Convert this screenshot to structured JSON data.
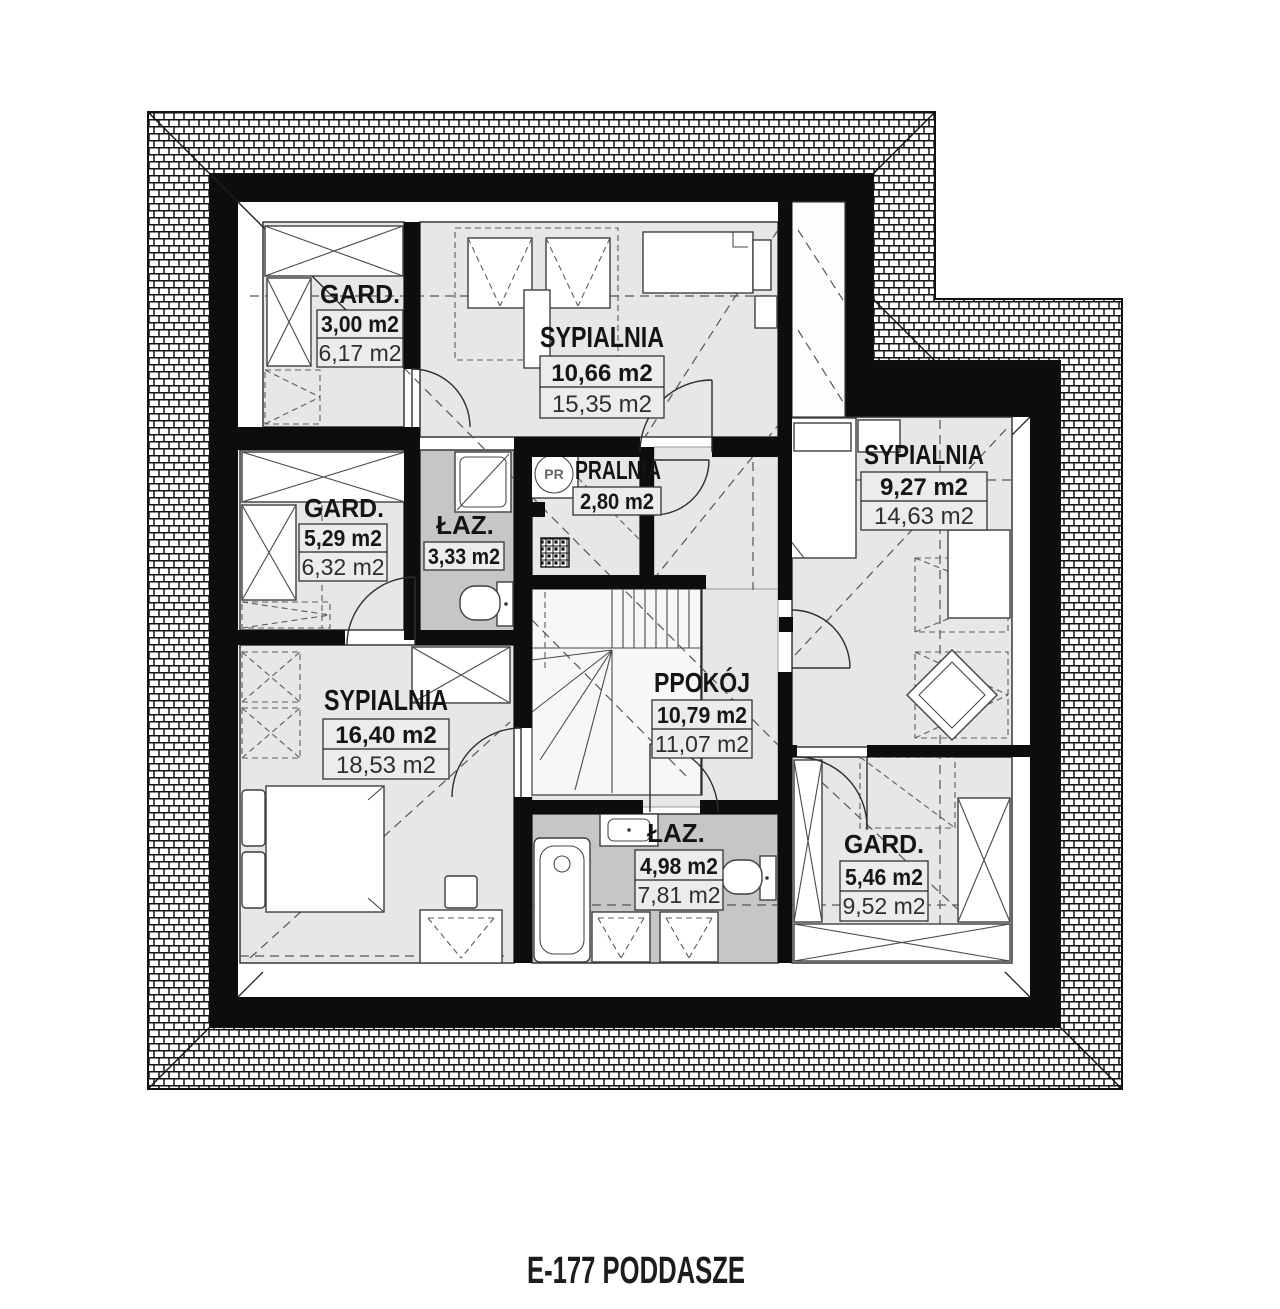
{
  "title": "E-177 PODDASZE",
  "icons": {
    "washing_machine_label": "PR"
  },
  "colors": {
    "wall": "#0d0d0d",
    "room_fill": "#e7e7e7",
    "bathroom_fill": "#c6c6c6",
    "line": "#111111"
  },
  "rooms": [
    {
      "id": "gard-nw",
      "name": "GARD.",
      "area1": "3,00 m2",
      "area2": "6,17 m2"
    },
    {
      "id": "sypialnia-n",
      "name": "SYPIALNIA",
      "area1": "10,66 m2",
      "area2": "15,35 m2"
    },
    {
      "id": "pralnia",
      "name": "PRALNIA",
      "area1": "2,80 m2",
      "area2": null
    },
    {
      "id": "laz-n",
      "name": "ŁAZ.",
      "area1": "3,33 m2",
      "area2": null
    },
    {
      "id": "gard-w",
      "name": "GARD.",
      "area1": "5,29 m2",
      "area2": "6,32 m2"
    },
    {
      "id": "sypialnia-e",
      "name": "SYPIALNIA",
      "area1": "9,27 m2",
      "area2": "14,63 m2"
    },
    {
      "id": "sypialnia-sw",
      "name": "SYPIALNIA",
      "area1": "16,40 m2",
      "area2": "18,53 m2"
    },
    {
      "id": "ppokoj",
      "name": "PPOKÓJ",
      "area1": "10,79 m2",
      "area2": "11,07 m2"
    },
    {
      "id": "laz-s",
      "name": "ŁAZ.",
      "area1": "4,98 m2",
      "area2": "7,81 m2"
    },
    {
      "id": "gard-se",
      "name": "GARD.",
      "area1": "5,46 m2",
      "area2": "9,52 m2"
    }
  ]
}
